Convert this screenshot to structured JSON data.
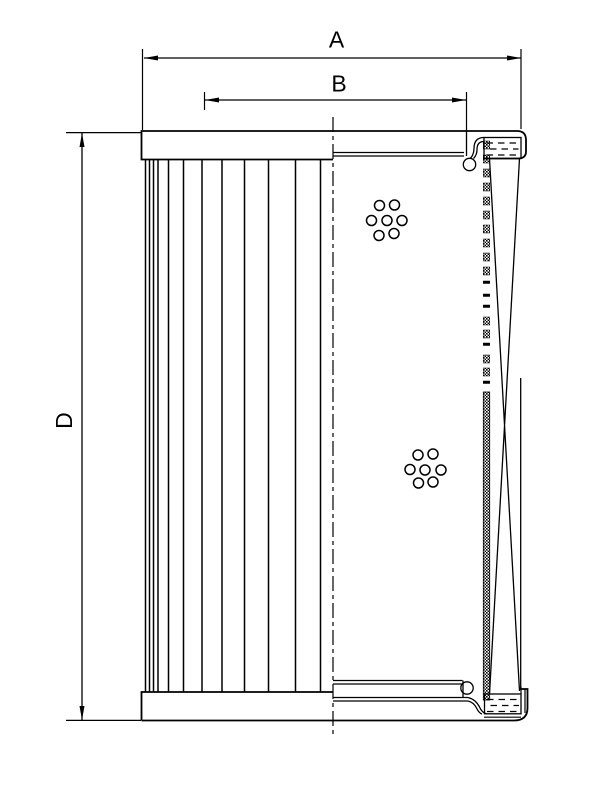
{
  "page": {
    "background": "#ffffff",
    "ink": "#000000"
  },
  "drawing": {
    "kind": "filter-element-technical-drawing",
    "dimension_labels": {
      "a": "A",
      "b": "B",
      "d": "D"
    },
    "features": {
      "pleat_line_count": 12,
      "upper_perforation_hole_count": 7,
      "lower_perforation_hole_count": 7
    }
  }
}
